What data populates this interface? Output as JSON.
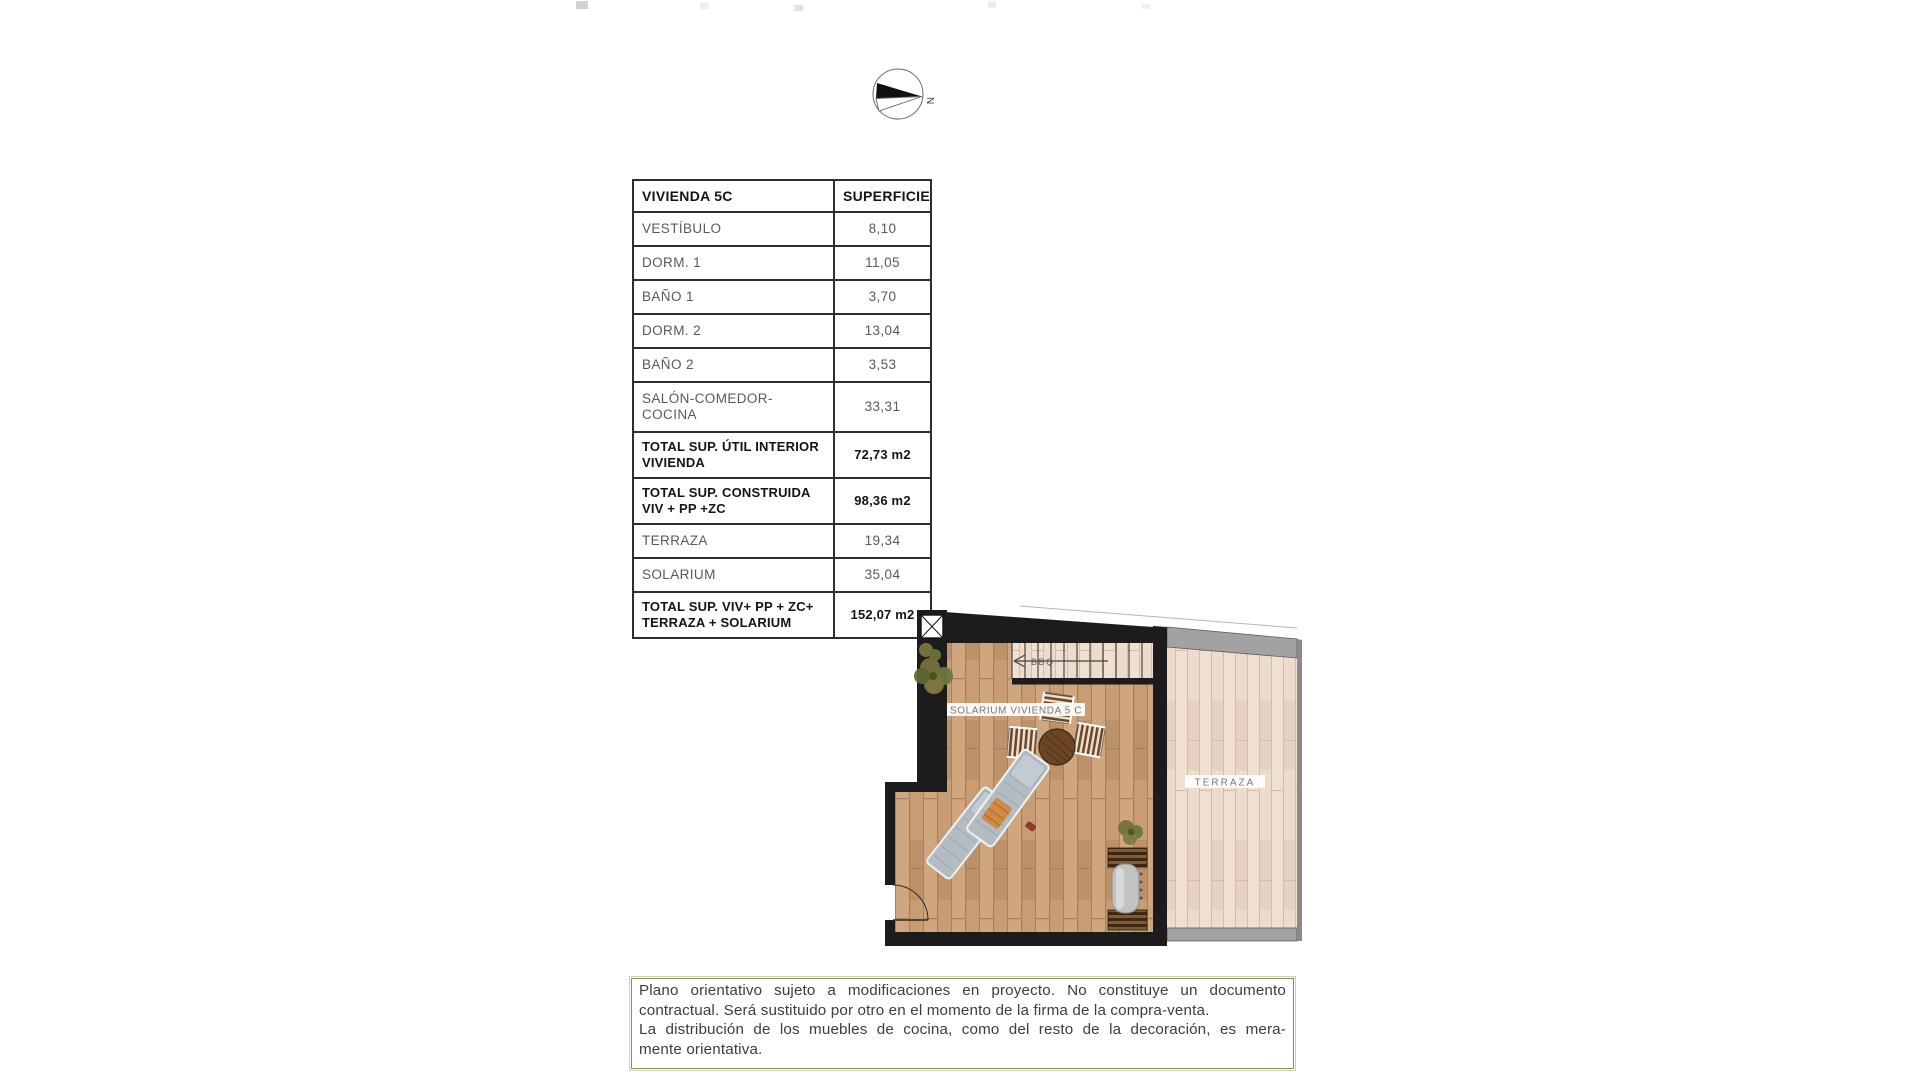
{
  "compass": {
    "north_label": "N"
  },
  "table": {
    "col1_header": "VIVIENDA 5C",
    "col2_header": "SUPERFICIE",
    "rows": [
      {
        "label": "VESTÍBULO",
        "value": "8,10",
        "bold": false
      },
      {
        "label": "DORM. 1",
        "value": "11,05",
        "bold": false
      },
      {
        "label": "BAÑO 1",
        "value": "3,70",
        "bold": false
      },
      {
        "label": "DORM. 2",
        "value": "13,04",
        "bold": false
      },
      {
        "label": "BAÑO 2",
        "value": "3,53",
        "bold": false
      },
      {
        "label": "SALÓN-COMEDOR-COCINA",
        "value": "33,31",
        "bold": false
      },
      {
        "label": "TOTAL SUP. ÚTIL INTERIOR\nVIVIENDA",
        "value": "72,73 m2",
        "bold": true
      },
      {
        "label": "TOTAL SUP. CONSTRUIDA\nVIV + PP +ZC",
        "value": "98,36 m2",
        "bold": true
      },
      {
        "label": "TERRAZA",
        "value": "19,34",
        "bold": false
      },
      {
        "label": "SOLARIUM",
        "value": "35,04",
        "bold": false
      },
      {
        "label": "TOTAL SUP. VIV+ PP + ZC+\nTERRAZA + SOLARIUM",
        "value": "152,07 m2",
        "bold": true
      }
    ]
  },
  "plan": {
    "solarium_label": "SOLARIUM VIVIENDA 5 C",
    "terraza_label": "TERRAZA",
    "stair_label": "BBQ"
  },
  "disclaimer": {
    "lines": [
      "Plano orientativo sujeto a modificaciones en proyecto. No constituye un documento",
      "contractual. Será sustituido por otro en el momento de la firma de la compra-venta.",
      "La distribución de los muebles de cocina, como del resto de la decoración, es mera-",
      "mente orientativa."
    ]
  },
  "colors": {
    "wall": "#1c1c1c",
    "solarium_wood": "#c69b73",
    "terraza_wood": "#ecdaca",
    "parapet_gray": "#a2a2a2",
    "disclaimer_border": "#8f8a5c",
    "table_border": "#2e2e2e",
    "label_text": "#7a7a7a"
  }
}
